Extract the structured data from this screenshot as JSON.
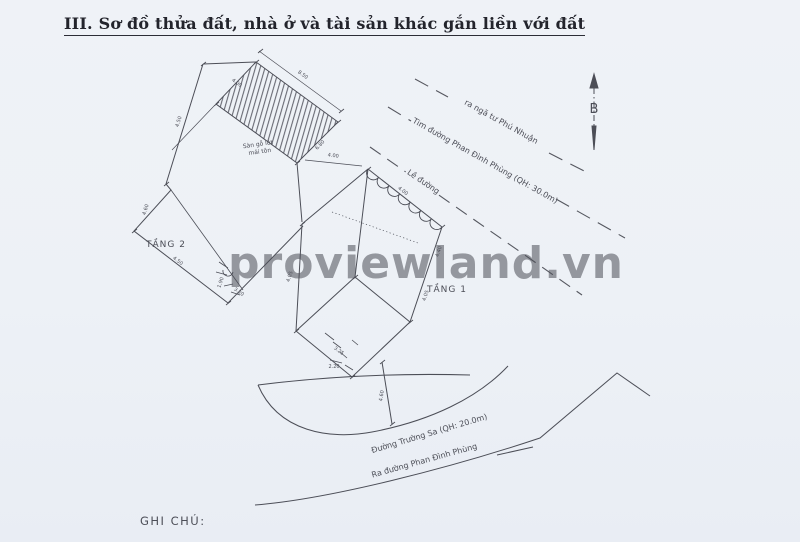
{
  "page": {
    "title": "III. Sơ đồ thửa đất, nhà ở và tài sản khác gắn liền với đất",
    "note_label": "GHI CHÚ:",
    "watermark": "proviewland.vn"
  },
  "plan": {
    "floor2_label": "TẦNG 2",
    "floor1_label": "TẦNG 1",
    "north_label": "B",
    "road_edge_label": "Lề đường",
    "street_centerline_label": "Tim đường Phan Đình Phùng (QH: 30.0m)",
    "intersection_label": "ra ngã tư Phú Nhuận",
    "street_truongsa_label": "Đường Trường Sa (QH: 20.0m)",
    "street_exit_label": "Ra đường Phan Đình Phùng",
    "hatch_note_line1": "Sàn gỗ lót",
    "hatch_note_line2": "mái tôn",
    "dimensions": [
      "8.50",
      "4.50",
      "4.60",
      "4.00",
      "6.80",
      "4.00",
      "4.40",
      "4.05",
      "3.25",
      "2.20",
      "1.90",
      "4.60",
      "4.00",
      "4.05",
      "4.50",
      "3.20"
    ]
  },
  "colors": {
    "ink": "#4c4e57",
    "watermark": "#8fd2de",
    "paper": "#eef2f7",
    "faded_note": "#98a2af"
  }
}
